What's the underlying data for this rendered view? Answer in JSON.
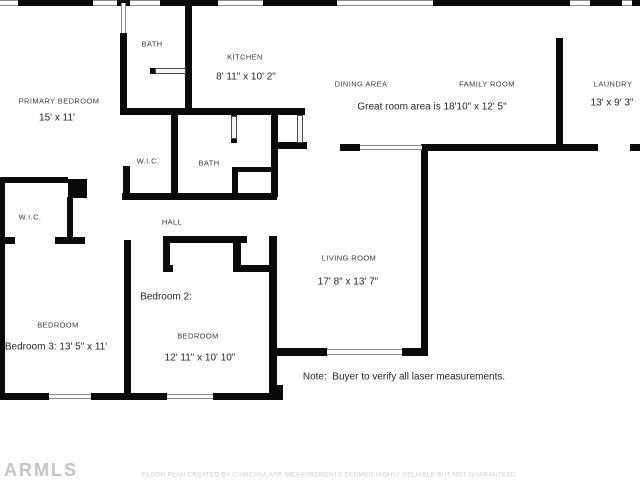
{
  "rooms": {
    "bath_top": {
      "label": "BATH"
    },
    "kitchen": {
      "label": "KITCHEN",
      "dims": "8' 11\" x 10' 2\""
    },
    "dining": {
      "label": "DINING AREA"
    },
    "family": {
      "label": "FAMILY ROOM"
    },
    "great_room": {
      "note": "Great room area is 18'10\" x 12' 5\""
    },
    "laundry": {
      "label": "LAUNDRY",
      "dims": "13' x 9' 3\""
    },
    "primary_bedroom": {
      "label": "PRIMARY BEDROOM",
      "dims": "15' x 11'"
    },
    "wic_upper": {
      "label": "W.I.C."
    },
    "bath_mid": {
      "label": "BATH"
    },
    "wic_left": {
      "label": "W.I.C."
    },
    "hall": {
      "label": "HALL"
    },
    "living_room": {
      "label": "LIVING ROOM",
      "dims": "17' 8\" x 13' 7\""
    },
    "bedroom2": {
      "title": "Bedroom 2:",
      "label": "BEDROOM",
      "dims": "12' 11\" x 10' 10\""
    },
    "bedroom3": {
      "label": "BEDROOM",
      "dims": "Bedroom 3: 13' 5\" x 11'"
    }
  },
  "note": "Note:  Buyer to verify all laser measurements.",
  "watermark": "ARMLS",
  "footer": "FLOOR PLAN CREATED BY CUBICASA APP. MEASUREMENTS DEEMED HIGHLY RELIABLE BUT NOT GUARANTEED.",
  "colors": {
    "wall": "#0a0a0a",
    "text": "#2b2b2b",
    "muted": "#cfcfcf"
  }
}
